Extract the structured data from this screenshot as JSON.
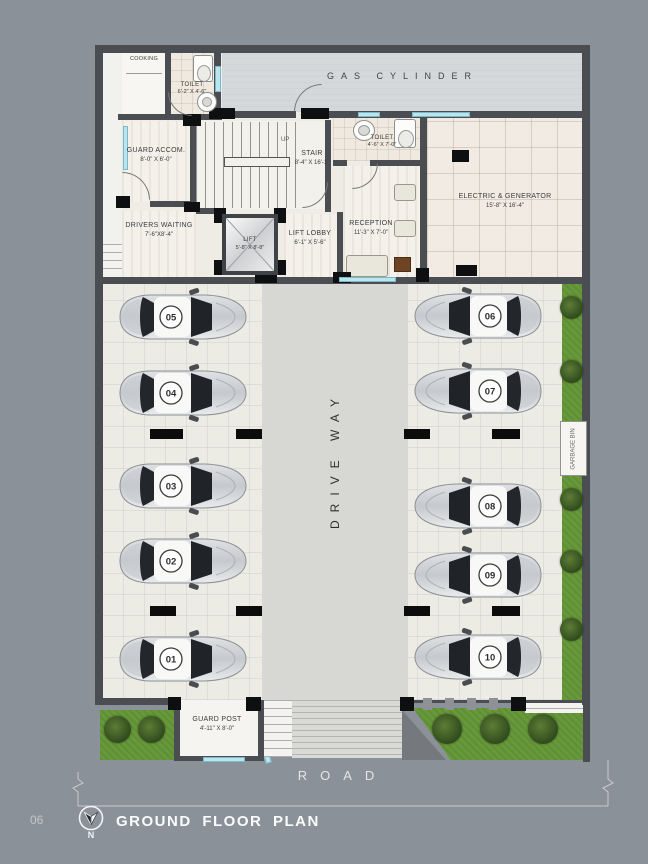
{
  "page": {
    "number": "06",
    "title": "GROUND FLOOR PLAN",
    "north_label": "N"
  },
  "plan": {
    "rooms": {
      "cooking": {
        "label": "COOKING"
      },
      "toilet_top": {
        "label": "TOILET",
        "size": "6'-2\" X 4'-6\""
      },
      "gas_cylinder": {
        "label": "GAS CYLINDER"
      },
      "guard_accom": {
        "label": "GUARD ACCOM.",
        "size": "8'-0\" X 6'-0\""
      },
      "stair": {
        "label": "STAIR",
        "size": "8'-4\" X 16'-1\"",
        "direction": "UP"
      },
      "toilet_mid": {
        "label": "TOILET",
        "size": "4'-6\" X 7'-0\""
      },
      "electric_generator": {
        "label": "ELECTRIC & GENERATOR",
        "size": "15'-8\" X 16'-4\""
      },
      "drivers_waiting": {
        "label": "DRIVERS WAITING",
        "size": "7'-6\"X8'-4\""
      },
      "lift": {
        "label": "LIFT",
        "size": "5'-8\" X 8'-8\""
      },
      "lift_lobby": {
        "label": "LIFT LOBBY",
        "size": "6'-1\" X 5'-6\""
      },
      "reception": {
        "label": "RECEPTION",
        "size": "11'-3\" X 7'-0\""
      },
      "guard_post": {
        "label": "GUARD POST",
        "size": "4'-11\" X 8'-0\""
      }
    },
    "driveway_label": "DRIVE WAY",
    "garbage_label": "GARBAGE BIN",
    "road_label": "ROAD",
    "parking": {
      "left_column": [
        "05",
        "04",
        "03",
        "02",
        "01"
      ],
      "right_column": [
        "06",
        "07",
        "08",
        "09",
        "10"
      ]
    },
    "colors": {
      "background": "#8b9199",
      "wall": "#4a4e52",
      "window": "#b7e6f0",
      "green": "#67993a",
      "driveway": "#d7d7d3"
    }
  }
}
